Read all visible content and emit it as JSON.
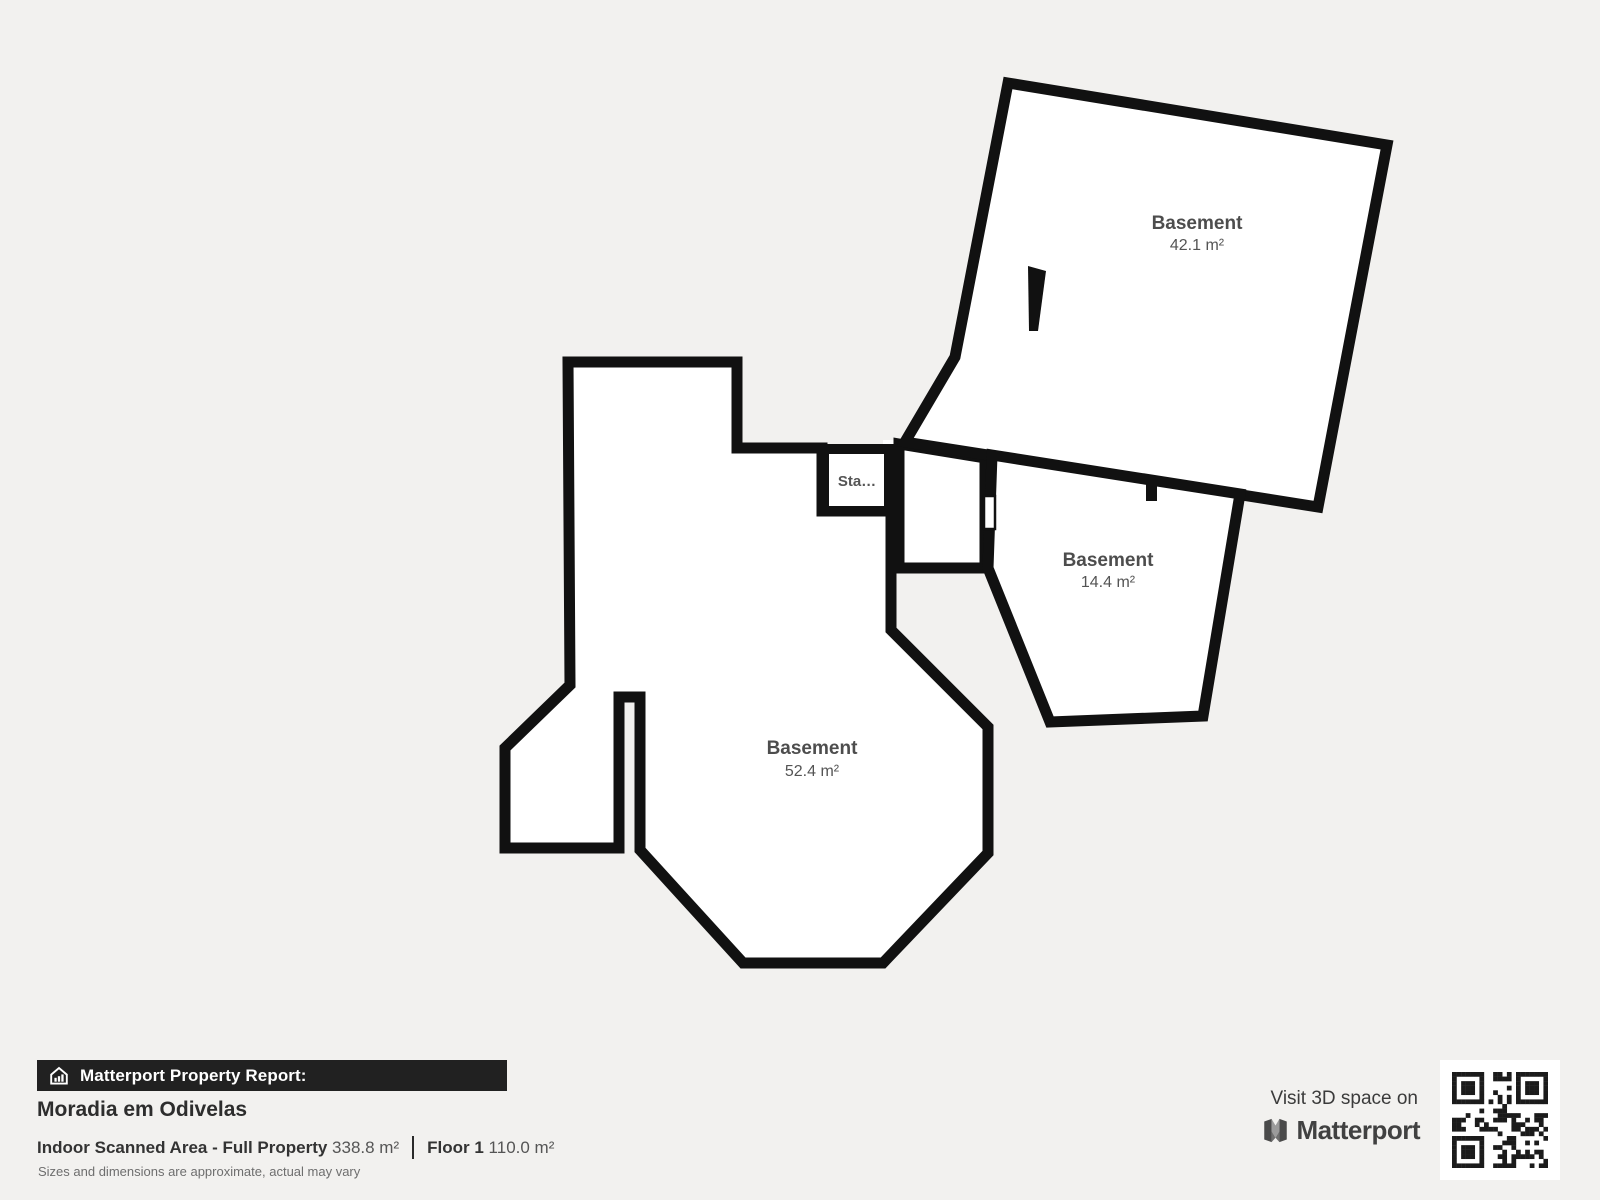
{
  "background": "#f2f1ef",
  "floor_plan": {
    "wall_color": "#111111",
    "room_fill": "#ffffff",
    "rooms": [
      {
        "name": "Basement",
        "area": "42.1 m²"
      },
      {
        "name": "Basement",
        "area": "14.4 m²"
      },
      {
        "name": "Basement",
        "area": "52.4 m²"
      },
      {
        "name": "Sta…",
        "area": ""
      }
    ]
  },
  "report": {
    "banner": {
      "label": "Matterport Property Report:",
      "icon": "house-chart-icon",
      "bg": "#212121"
    },
    "property_name": "Moradia em Odivelas",
    "stats": [
      {
        "label": "Indoor Scanned Area - Full Property",
        "value": "338.8 m²"
      },
      {
        "label": "Floor 1",
        "value": "110.0 m²"
      }
    ],
    "disclaimer": "Sizes and dimensions are approximate, actual may vary"
  },
  "cta": {
    "line": "Visit 3D space on",
    "brand": "Matterport",
    "qr": "qr-code",
    "qr_color": "#1b1b1b"
  }
}
